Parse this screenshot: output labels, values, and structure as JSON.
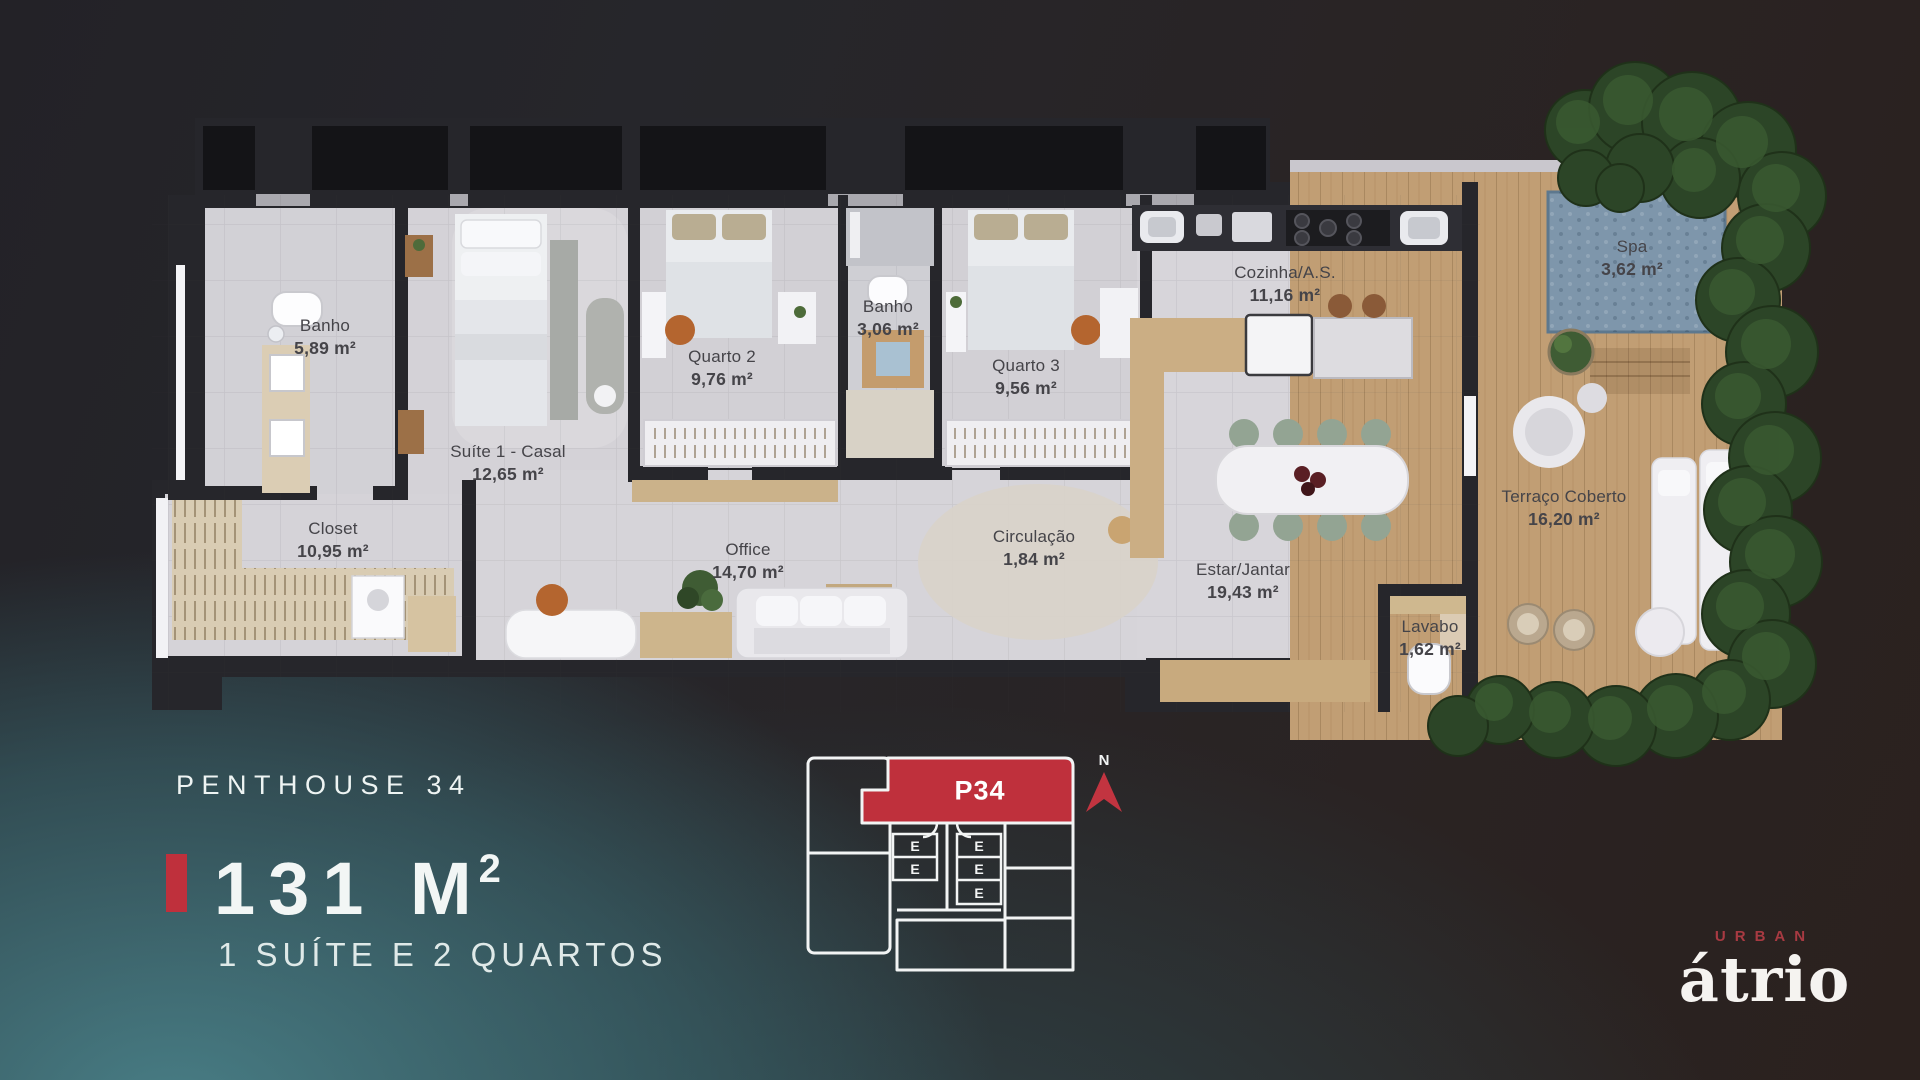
{
  "panel": {
    "project_label": "PENTHOUSE 34",
    "area_value": "131 M",
    "area_sup": "2",
    "subtitle": "1 SUÍTE E 2 QUARTOS"
  },
  "plan": {
    "rooms": [
      {
        "name": "Banho",
        "area": "5,89 m²"
      },
      {
        "name": "Suíte 1 - Casal",
        "area": "12,65 m²"
      },
      {
        "name": "Closet",
        "area": "10,95 m²"
      },
      {
        "name": "Quarto 2",
        "area": "9,76 m²"
      },
      {
        "name": "Banho",
        "area": "3,06 m²"
      },
      {
        "name": "Quarto 3",
        "area": "9,56 m²"
      },
      {
        "name": "Office",
        "area": "14,70 m²"
      },
      {
        "name": "Circulação",
        "area": "1,84 m²"
      },
      {
        "name": "Cozinha/A.S.",
        "area": "11,16 m²"
      },
      {
        "name": "Estar/Jantar",
        "area": "19,43 m²"
      },
      {
        "name": "Lavabo",
        "area": "1,62 m²"
      },
      {
        "name": "Spa",
        "area": "3,62 m²"
      },
      {
        "name": "Terraço Coberto",
        "area": "16,20 m²"
      }
    ]
  },
  "keyplan": {
    "unit_label": "P34",
    "north_label": "N",
    "elevator_labels": [
      "E",
      "E",
      "E",
      "E",
      "E"
    ]
  },
  "logo": {
    "brand_top": "URBAN",
    "brand_name": "átrio"
  },
  "colors": {
    "accent_red": "#bf303c",
    "teal_glow": "#3d6d75",
    "wall": "#26262b",
    "floor": "#d6d3d8",
    "wood_deck": "#c19e74",
    "spa_water": "#7e96ab",
    "vegetation": "#2c4527"
  }
}
